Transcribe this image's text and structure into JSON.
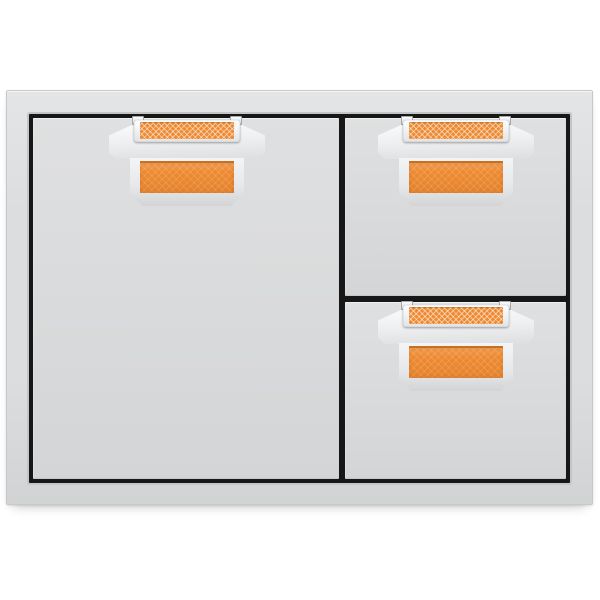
{
  "image": {
    "kind": "product-photo",
    "subject": "outdoor kitchen single door and double drawer combo",
    "finish": "stainless steel",
    "accent_finish": "orange"
  },
  "product": {
    "sections": [
      {
        "id": "door",
        "name": "access door",
        "position": "left",
        "handle": "orange accent pull handle"
      },
      {
        "id": "top-drawer",
        "name": "top storage drawer",
        "position": "right-upper",
        "handle": "orange accent pull handle"
      },
      {
        "id": "bottom-drawer",
        "name": "bottom storage drawer",
        "position": "right-lower",
        "handle": "orange accent pull handle"
      }
    ],
    "handle_parts": [
      "mount-tabs",
      "crosshatch-accent-strip",
      "chrome-bracket",
      "chrome-lower-frame",
      "accent-panel"
    ]
  },
  "colors": {
    "background": "#ffffff",
    "frame-steel": "#dcddde",
    "panel-steel": "#d9dadb",
    "reveal-black": "#171717",
    "accent": "#ee8a31",
    "accent-dark": "#c96f20",
    "chrome-light": "#fbfcfd",
    "chrome-shadow": "#dcdee0"
  }
}
